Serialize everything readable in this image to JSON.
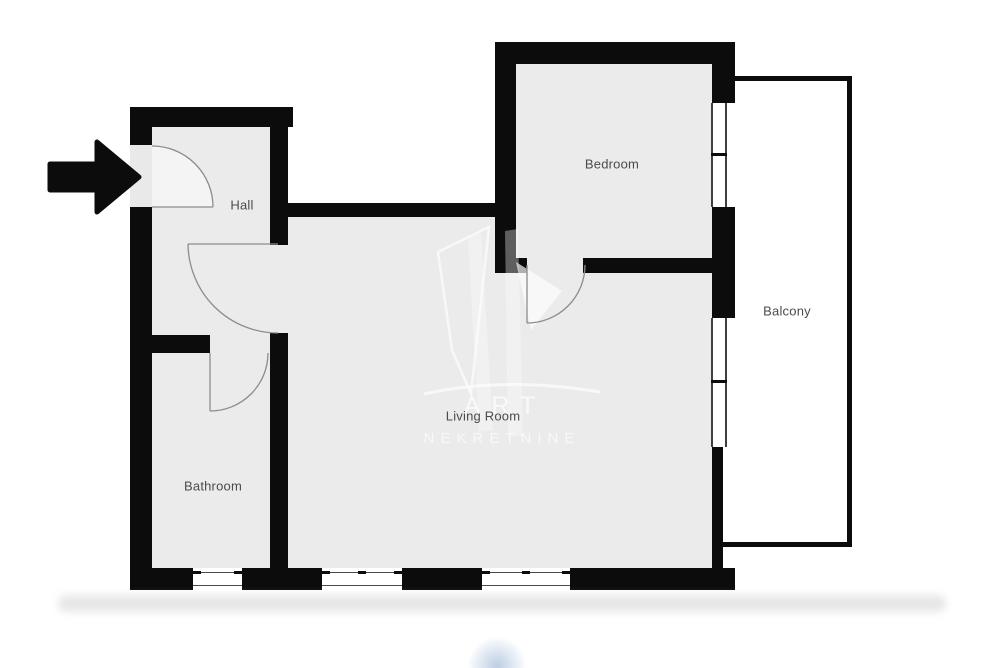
{
  "floorplan": {
    "rooms": [
      {
        "name": "Hall"
      },
      {
        "name": "Bathroom"
      },
      {
        "name": "Living Room"
      },
      {
        "name": "Bedroom"
      },
      {
        "name": "Balcony"
      }
    ],
    "watermark": {
      "line1": "ART",
      "line2": "NEKRETNINE"
    },
    "colors": {
      "wall": "#0c0c0c",
      "floor": "#ebebeb",
      "balcony_fill": "#ffffff",
      "label_text": "#4b4b4b",
      "door_line": "#8c8c8c"
    },
    "icons": {
      "entrance": "entrance-arrow-icon"
    }
  }
}
